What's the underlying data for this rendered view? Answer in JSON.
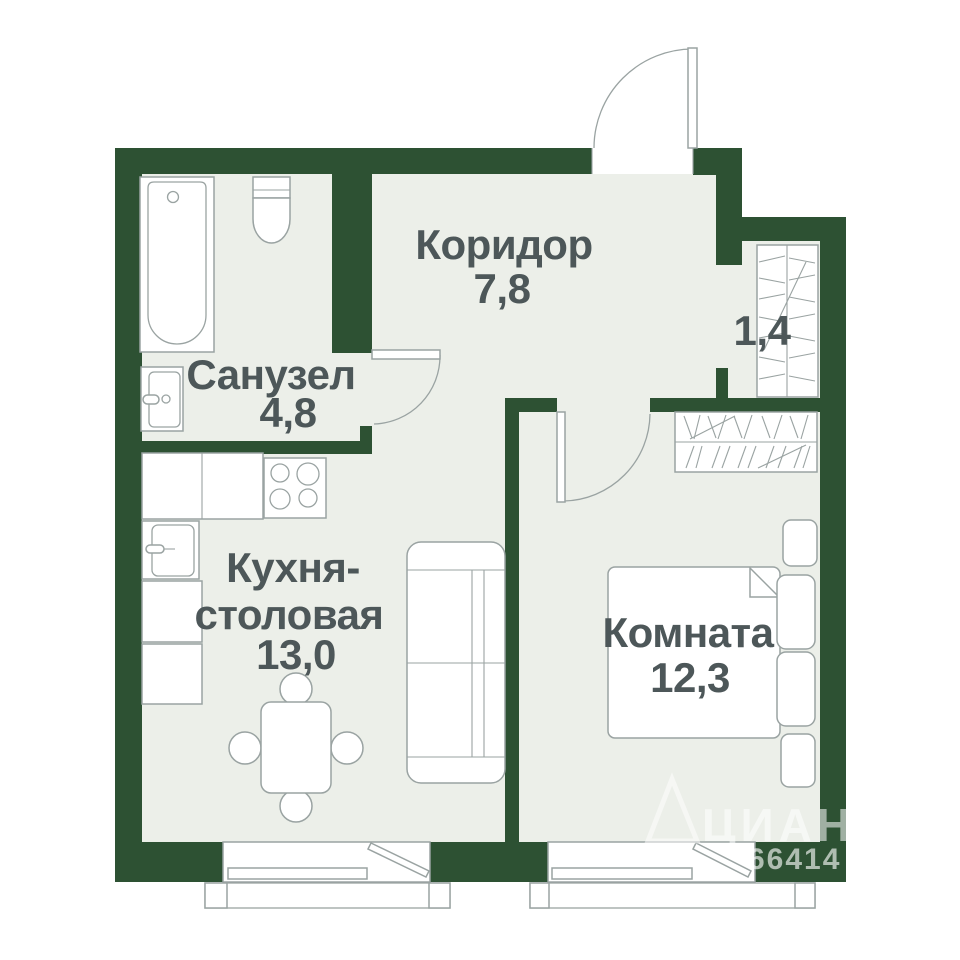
{
  "rooms": {
    "corridor": {
      "name": "Коридор",
      "area": "7,8"
    },
    "bathroom": {
      "name": "Санузел",
      "area": "4,8"
    },
    "kitchen": {
      "name_line1": "Кухня-",
      "name_line2": "столовая",
      "area": "13,0"
    },
    "bedroom": {
      "name": "Комната",
      "area": "12,3"
    },
    "closet": {
      "area": "1,4"
    }
  },
  "watermark": {
    "brand": "ЦИАН",
    "number": "66414"
  },
  "colors": {
    "wall": "#2d5133",
    "floor": "#ecefe9",
    "outline": "#9aa3a2",
    "text": "#4d5759",
    "fixture": "#ffffff",
    "background": "#ffffff"
  }
}
